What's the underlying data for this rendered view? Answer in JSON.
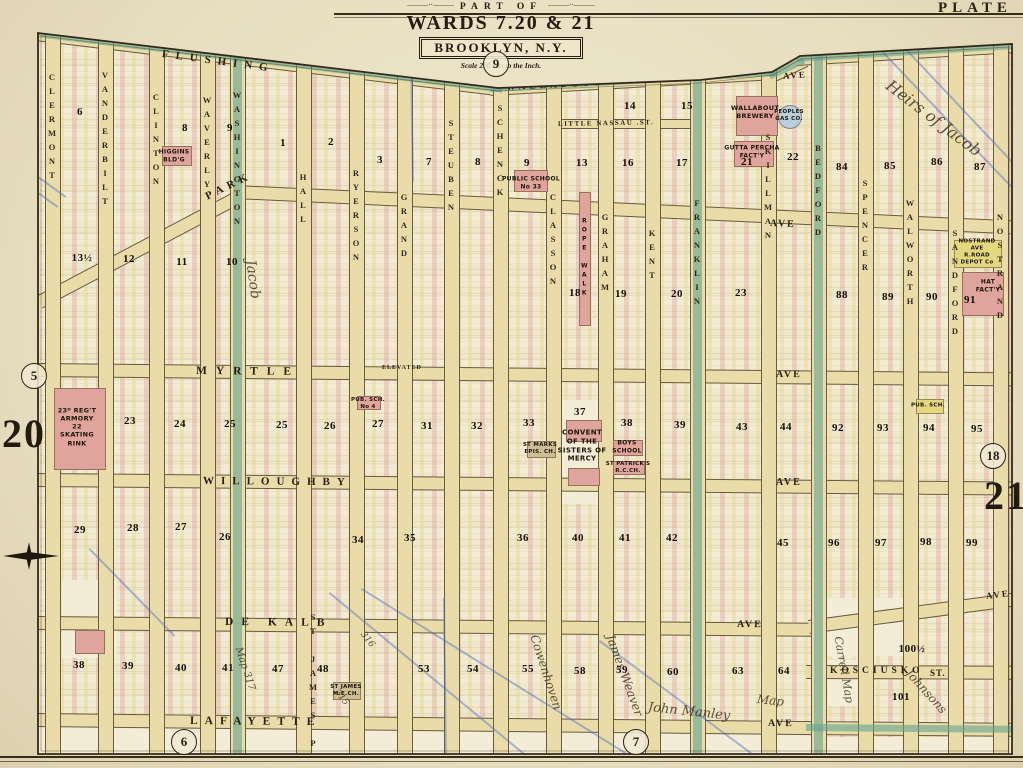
{
  "plate": {
    "label": "PLATE",
    "page_number_left": "20",
    "page_number_right": "21",
    "adjacent_plates": {
      "top": "9",
      "left": "5",
      "bottom_left": "6",
      "bottom_center": "7",
      "right": "18"
    },
    "title": {
      "part_of": "PART OF",
      "wards": "WARDS 7.20 & 21",
      "city": "BROOKLYN, N.Y.",
      "scale": "Scale 200 feet to the Inch."
    }
  },
  "colors": {
    "paper": "#e8dfc1",
    "sheet": "#f0e8cd",
    "street": "#e9dca9",
    "teal_street": "#62a48e",
    "lot_pink": "#dfa49c",
    "lot_yellow": "#e4d87e",
    "cream": "#f3edd7",
    "tan": "#cdbd92",
    "ink": "#271f10",
    "blue_pencil": "#4b6cbe"
  },
  "streets": {
    "vertical": [
      {
        "name": "CLERMONT",
        "x": 52,
        "y0": 35,
        "ly": 72,
        "teal": false
      },
      {
        "name": "VANDERBILT",
        "x": 105,
        "y0": 41,
        "ly": 70,
        "teal": false
      },
      {
        "name": "CLINTON",
        "x": 156,
        "y0": 47,
        "ly": 92,
        "teal": false
      },
      {
        "name": "WAVERLY",
        "x": 207,
        "y0": 53,
        "ly": 95,
        "teal": false
      },
      {
        "name": "WASHINGTON",
        "x": 237,
        "y0": 57,
        "ly": 90,
        "teal": true
      },
      {
        "name": "HALL",
        "x": 303,
        "y0": 65,
        "ly": 172,
        "teal": false
      },
      {
        "name": "RYERSON",
        "x": 356,
        "y0": 71,
        "ly": 168,
        "teal": false
      },
      {
        "name": "GRAND",
        "x": 404,
        "y0": 77,
        "ly": 192,
        "teal": false
      },
      {
        "name": "STEUBEN",
        "x": 451,
        "y0": 82,
        "ly": 118,
        "teal": false
      },
      {
        "name": "SCHENCK",
        "x": 500,
        "y0": 88,
        "ly": 103,
        "teal": false
      },
      {
        "name": "CLASSON",
        "x": 553,
        "y0": 85,
        "ly": 192,
        "teal": false
      },
      {
        "name": "GRAHAM",
        "x": 605,
        "y0": 82,
        "ly": 212,
        "teal": false
      },
      {
        "name": "KENT",
        "x": 652,
        "y0": 79,
        "ly": 228,
        "teal": false
      },
      {
        "name": "FRANKLIN",
        "x": 697,
        "y0": 76,
        "ly": 198,
        "teal": true
      },
      {
        "name": "SKILLMAN",
        "x": 768,
        "y0": 72,
        "ly": 132,
        "teal": false
      },
      {
        "name": "BEDFORD",
        "x": 818,
        "y0": 55,
        "ly": 143,
        "teal": true
      },
      {
        "name": "SPENCER",
        "x": 865,
        "y0": 52,
        "ly": 178,
        "teal": false
      },
      {
        "name": "WALWORTH",
        "x": 910,
        "y0": 50,
        "ly": 198,
        "teal": false
      },
      {
        "name": "SANDFORD",
        "x": 955,
        "y0": 47,
        "ly": 228,
        "teal": false
      },
      {
        "name": "NOSTRAND",
        "x": 1000,
        "y0": 45,
        "ly": 212,
        "teal": false
      },
      {
        "name": "ST JAMES PL",
        "x": 313,
        "y0": 615,
        "ly": 612,
        "teal": false,
        "noband": true
      }
    ],
    "horizontal": [
      {
        "name": "flushing",
        "x": 36,
        "y": 27,
        "len": 470,
        "rot": 6.8,
        "teal": true
      },
      {
        "name": "wallabout-road",
        "x": 490,
        "y": 82,
        "len": 286,
        "rot": -3.2,
        "teal": true
      },
      {
        "name": "road-bend",
        "x": 768,
        "y": 70,
        "len": 38,
        "rot": -25,
        "teal": true
      },
      {
        "name": "flushing-ave-east",
        "x": 796,
        "y": 52,
        "len": 218,
        "rot": -3.4,
        "teal": true
      },
      {
        "name": "little-nassau",
        "x": 553,
        "y": 119,
        "len": 150,
        "rot": 0,
        "thin": true,
        "teal": false
      },
      {
        "name": "park-diagonal",
        "x": 36,
        "y": 296,
        "len": 228,
        "rot": -27.8,
        "teal": false
      },
      {
        "name": "park",
        "x": 234,
        "y": 185,
        "len": 778,
        "rot": 2.6,
        "teal": false
      },
      {
        "name": "myrtle",
        "x": 36,
        "y": 363,
        "len": 976,
        "rot": 0.55,
        "teal": false
      },
      {
        "name": "willoughby",
        "x": 36,
        "y": 473,
        "len": 976,
        "rot": 0.5,
        "teal": false
      },
      {
        "name": "dekalb",
        "x": 36,
        "y": 616,
        "len": 777,
        "rot": 0.5,
        "teal": false
      },
      {
        "name": "dekalb-east",
        "x": 808,
        "y": 620,
        "len": 206,
        "rot": -7.6,
        "teal": false
      },
      {
        "name": "lafayette",
        "x": 36,
        "y": 713,
        "len": 777,
        "rot": 0.6,
        "teal": false
      },
      {
        "name": "lafayette-east",
        "x": 806,
        "y": 721,
        "len": 206,
        "rot": 0.5,
        "teal": true
      },
      {
        "name": "kosciusko",
        "x": 806,
        "y": 665,
        "len": 206,
        "rot": 0.2,
        "teal": false
      }
    ],
    "labels": [
      {
        "t": "FLUSHING",
        "x": 162,
        "y": 48,
        "rot": 7.5,
        "sp": 7,
        "sz": 11
      },
      {
        "t": "WALLABOUT",
        "x": 506,
        "y": 83,
        "rot": -3,
        "sp": 4,
        "sz": 9.5
      },
      {
        "t": "ROAD",
        "x": 775,
        "y": 56,
        "rot": -23,
        "sp": 3,
        "sz": 9
      },
      {
        "t": "AVE",
        "x": 783,
        "y": 71,
        "rot": -4,
        "sp": 2,
        "sz": 9
      },
      {
        "t": "LITTLE NASSAU .ST.",
        "x": 558,
        "y": 120,
        "rot": -1,
        "sp": 1.5,
        "sz": 7
      },
      {
        "t": "PARK",
        "x": 206,
        "y": 191,
        "rot": -26,
        "sp": 5,
        "sz": 11
      },
      {
        "t": "AVE",
        "x": 770,
        "y": 218,
        "rot": 2,
        "sp": 2,
        "sz": 10
      },
      {
        "t": "MYRTLE",
        "x": 196,
        "y": 365,
        "rot": 0.5,
        "sp": 9,
        "sz": 11.5
      },
      {
        "t": "ELEVATED",
        "x": 382,
        "y": 365,
        "rot": 0,
        "sp": 1,
        "sz": 6
      },
      {
        "t": "AVE",
        "x": 776,
        "y": 369,
        "rot": 0.5,
        "sp": 2,
        "sz": 10
      },
      {
        "t": "WILLOUGHBY",
        "x": 203,
        "y": 475,
        "rot": 0.5,
        "sp": 7,
        "sz": 11
      },
      {
        "t": "AVE",
        "x": 776,
        "y": 477,
        "rot": 0,
        "sp": 2,
        "sz": 10
      },
      {
        "t": "DE KALB",
        "x": 225,
        "y": 616,
        "rot": 0.5,
        "sp": 8,
        "sz": 11.5
      },
      {
        "t": "AVE",
        "x": 737,
        "y": 619,
        "rot": 0.5,
        "sp": 2,
        "sz": 10
      },
      {
        "t": "AVE",
        "x": 986,
        "y": 591,
        "rot": -7,
        "sp": 2,
        "sz": 9
      },
      {
        "t": "LAFAYETTE",
        "x": 190,
        "y": 715,
        "rot": 0.5,
        "sp": 7,
        "sz": 11.5
      },
      {
        "t": "AVE",
        "x": 768,
        "y": 718,
        "rot": 0.5,
        "sp": 2,
        "sz": 10
      },
      {
        "t": "KOSCIUSKO",
        "x": 830,
        "y": 666,
        "rot": 0,
        "sp": 4,
        "sz": 9.5
      },
      {
        "t": "ST.",
        "x": 930,
        "y": 668,
        "rot": 0,
        "sp": 1,
        "sz": 9
      }
    ]
  },
  "blocks": [
    {
      "n": "6",
      "x": 80,
      "y": 112
    },
    {
      "n": "8",
      "x": 185,
      "y": 128
    },
    {
      "n": "9",
      "x": 230,
      "y": 128
    },
    {
      "n": "1",
      "x": 283,
      "y": 143
    },
    {
      "n": "2",
      "x": 331,
      "y": 142
    },
    {
      "n": "3",
      "x": 380,
      "y": 160
    },
    {
      "n": "7",
      "x": 429,
      "y": 162
    },
    {
      "n": "8",
      "x": 478,
      "y": 162
    },
    {
      "n": "9",
      "x": 527,
      "y": 163
    },
    {
      "n": "13",
      "x": 582,
      "y": 163
    },
    {
      "n": "14",
      "x": 630,
      "y": 106
    },
    {
      "n": "15",
      "x": 687,
      "y": 106
    },
    {
      "n": "16",
      "x": 628,
      "y": 163
    },
    {
      "n": "17",
      "x": 682,
      "y": 163
    },
    {
      "n": "21",
      "x": 747,
      "y": 162
    },
    {
      "n": "22",
      "x": 793,
      "y": 157
    },
    {
      "n": "84",
      "x": 842,
      "y": 167
    },
    {
      "n": "85",
      "x": 890,
      "y": 166
    },
    {
      "n": "86",
      "x": 937,
      "y": 162
    },
    {
      "n": "87",
      "x": 980,
      "y": 167
    },
    {
      "n": "13½",
      "x": 82,
      "y": 258
    },
    {
      "n": "12",
      "x": 129,
      "y": 259
    },
    {
      "n": "11",
      "x": 182,
      "y": 262
    },
    {
      "n": "10",
      "x": 232,
      "y": 262
    },
    {
      "n": "18",
      "x": 575,
      "y": 293
    },
    {
      "n": "19",
      "x": 621,
      "y": 294
    },
    {
      "n": "20",
      "x": 677,
      "y": 294
    },
    {
      "n": "23",
      "x": 741,
      "y": 293
    },
    {
      "n": "88",
      "x": 842,
      "y": 295
    },
    {
      "n": "89",
      "x": 888,
      "y": 297
    },
    {
      "n": "90",
      "x": 932,
      "y": 297
    },
    {
      "n": "91",
      "x": 970,
      "y": 300
    },
    {
      "n": "23",
      "x": 130,
      "y": 421
    },
    {
      "n": "24",
      "x": 180,
      "y": 424
    },
    {
      "n": "25",
      "x": 230,
      "y": 424
    },
    {
      "n": "25",
      "x": 282,
      "y": 425
    },
    {
      "n": "26",
      "x": 330,
      "y": 426
    },
    {
      "n": "27",
      "x": 378,
      "y": 424
    },
    {
      "n": "31",
      "x": 427,
      "y": 426
    },
    {
      "n": "32",
      "x": 477,
      "y": 426
    },
    {
      "n": "33",
      "x": 529,
      "y": 423
    },
    {
      "n": "37",
      "x": 580,
      "y": 412
    },
    {
      "n": "38",
      "x": 627,
      "y": 423
    },
    {
      "n": "39",
      "x": 680,
      "y": 425
    },
    {
      "n": "43",
      "x": 742,
      "y": 427
    },
    {
      "n": "44",
      "x": 786,
      "y": 427
    },
    {
      "n": "92",
      "x": 838,
      "y": 428
    },
    {
      "n": "93",
      "x": 883,
      "y": 428
    },
    {
      "n": "94",
      "x": 929,
      "y": 428
    },
    {
      "n": "95",
      "x": 977,
      "y": 429
    },
    {
      "n": "29",
      "x": 80,
      "y": 530
    },
    {
      "n": "28",
      "x": 133,
      "y": 528
    },
    {
      "n": "27",
      "x": 181,
      "y": 527
    },
    {
      "n": "26",
      "x": 225,
      "y": 537
    },
    {
      "n": "34",
      "x": 358,
      "y": 540
    },
    {
      "n": "35",
      "x": 410,
      "y": 538
    },
    {
      "n": "36",
      "x": 523,
      "y": 538
    },
    {
      "n": "40",
      "x": 578,
      "y": 538
    },
    {
      "n": "41",
      "x": 625,
      "y": 538
    },
    {
      "n": "42",
      "x": 672,
      "y": 538
    },
    {
      "n": "45",
      "x": 783,
      "y": 543
    },
    {
      "n": "96",
      "x": 834,
      "y": 543
    },
    {
      "n": "97",
      "x": 881,
      "y": 543
    },
    {
      "n": "98",
      "x": 926,
      "y": 542
    },
    {
      "n": "99",
      "x": 972,
      "y": 543
    },
    {
      "n": "38",
      "x": 79,
      "y": 665
    },
    {
      "n": "39",
      "x": 128,
      "y": 666
    },
    {
      "n": "40",
      "x": 181,
      "y": 668
    },
    {
      "n": "41",
      "x": 228,
      "y": 668
    },
    {
      "n": "47",
      "x": 278,
      "y": 669
    },
    {
      "n": "48",
      "x": 323,
      "y": 669
    },
    {
      "n": "53",
      "x": 424,
      "y": 669
    },
    {
      "n": "54",
      "x": 473,
      "y": 669
    },
    {
      "n": "55",
      "x": 528,
      "y": 669
    },
    {
      "n": "58",
      "x": 580,
      "y": 671
    },
    {
      "n": "59",
      "x": 622,
      "y": 670
    },
    {
      "n": "60",
      "x": 673,
      "y": 672
    },
    {
      "n": "63",
      "x": 738,
      "y": 671
    },
    {
      "n": "64",
      "x": 784,
      "y": 671
    },
    {
      "n": "100½",
      "x": 912,
      "y": 649
    },
    {
      "n": "101",
      "x": 901,
      "y": 697
    }
  ],
  "landmarks": [
    {
      "t": "23ᴰ REG'T\nARMORY\n22\nSKATING\nRINK",
      "x": 77,
      "y": 427,
      "sz": 6.5
    },
    {
      "t": "HIGGINS\nBLD'G",
      "x": 174,
      "y": 156,
      "sz": 6
    },
    {
      "t": "PUBLIC SCHOOL\nNo 33",
      "x": 531,
      "y": 183,
      "sz": 6
    },
    {
      "t": "PUB. SCH.\nNo 4",
      "x": 368,
      "y": 404,
      "sz": 5.5
    },
    {
      "t": "ROPE WALK",
      "x": 584,
      "y": 258,
      "sz": 6,
      "vert": true
    },
    {
      "t": "WALLABOUT\nBREWERY",
      "x": 755,
      "y": 112,
      "sz": 6.5
    },
    {
      "t": "GUTTA PERCHA\nFACT'Y",
      "x": 752,
      "y": 152,
      "sz": 6
    },
    {
      "t": "PEOPLES\nGAS CO.",
      "x": 789,
      "y": 116,
      "sz": 5.5
    },
    {
      "t": "ST MARKS\nEPIS. CH.",
      "x": 540,
      "y": 449,
      "sz": 5.5
    },
    {
      "t": "CONVENT\nOF THE\nSISTERS OF\nMERCY",
      "x": 582,
      "y": 446,
      "sz": 7
    },
    {
      "t": "BOYS\nSCHOOL",
      "x": 627,
      "y": 447,
      "sz": 6
    },
    {
      "t": "ST PATRICK'S\nR.C.CH.",
      "x": 628,
      "y": 468,
      "sz": 5.5
    },
    {
      "t": "NOSTRAND AVE\nR.ROAD\nDEPOT Co",
      "x": 977,
      "y": 252,
      "sz": 5.5
    },
    {
      "t": "HAT\nFACT'Y",
      "x": 988,
      "y": 286,
      "sz": 6
    },
    {
      "t": "ST JAMES\nM.E.CH.",
      "x": 346,
      "y": 691,
      "sz": 5.5
    },
    {
      "t": "PUB. SCH.",
      "x": 928,
      "y": 406,
      "sz": 5.5
    }
  ],
  "annotations": [
    {
      "t": "Heirs of Jacob",
      "x": 888,
      "y": 74,
      "rot": 37,
      "sz": 16
    },
    {
      "t": "Jacob",
      "x": 250,
      "y": 252,
      "rot": 82,
      "sz": 14
    },
    {
      "t": "Cowenhoven",
      "x": 534,
      "y": 628,
      "rot": 72,
      "sz": 12
    },
    {
      "t": "James Weaver",
      "x": 610,
      "y": 628,
      "rot": 70,
      "sz": 12
    },
    {
      "t": "John Manley",
      "x": 648,
      "y": 700,
      "rot": 6,
      "sz": 13
    },
    {
      "t": "Map",
      "x": 757,
      "y": 692,
      "rot": 6,
      "sz": 12
    },
    {
      "t": "Johnsons",
      "x": 908,
      "y": 664,
      "rot": 48,
      "sz": 12
    },
    {
      "t": "Carrell Map",
      "x": 838,
      "y": 630,
      "rot": 80,
      "sz": 11
    },
    {
      "t": "Map 317",
      "x": 238,
      "y": 642,
      "rot": 72,
      "sz": 10
    },
    {
      "t": "316",
      "x": 362,
      "y": 628,
      "rot": 52,
      "sz": 9
    },
    {
      "t": "315",
      "x": 336,
      "y": 686,
      "rot": 52,
      "sz": 9
    }
  ],
  "pencil_lines": [
    {
      "x0": 0,
      "y0": 148,
      "x1": 66,
      "y1": 196
    },
    {
      "x0": 0,
      "y0": 164,
      "x1": 58,
      "y1": 206
    },
    {
      "x0": 884,
      "y0": 52,
      "x1": 1012,
      "y1": 186
    },
    {
      "x0": 908,
      "y0": 50,
      "x1": 1023,
      "y1": 172
    },
    {
      "x0": 330,
      "y0": 592,
      "x1": 540,
      "y1": 766
    },
    {
      "x0": 362,
      "y0": 588,
      "x1": 648,
      "y1": 766
    },
    {
      "x0": 445,
      "y0": 598,
      "x1": 447,
      "y1": 762
    },
    {
      "x0": 412,
      "y0": 58,
      "x1": 414,
      "y1": 182
    },
    {
      "x0": 499,
      "y0": 2,
      "x1": 501,
      "y1": 90
    },
    {
      "x0": 90,
      "y0": 548,
      "x1": 175,
      "y1": 635
    },
    {
      "x0": 600,
      "y0": 640,
      "x1": 770,
      "y1": 766
    }
  ],
  "patches": [
    {
      "x": 556,
      "y": 400,
      "w": 52,
      "h": 104,
      "c": "cream",
      "layer": 0
    },
    {
      "x": 826,
      "y": 598,
      "w": 82,
      "h": 58,
      "c": "cream",
      "layer": 0
    },
    {
      "x": 62,
      "y": 580,
      "w": 55,
      "h": 78,
      "c": "cream",
      "layer": 0
    },
    {
      "x": 828,
      "y": 660,
      "w": 46,
      "h": 46,
      "c": "cream",
      "layer": 0
    },
    {
      "x": 38,
      "y": 727,
      "w": 774,
      "h": 27,
      "c": "cream",
      "layer": 0
    },
    {
      "x": 806,
      "y": 737,
      "w": 206,
      "h": 17,
      "c": "cream",
      "layer": 0
    },
    {
      "x": 54,
      "y": 388,
      "w": 50,
      "h": 80,
      "c": "pink",
      "layer": 1
    },
    {
      "x": 566,
      "y": 420,
      "w": 34,
      "h": 20,
      "c": "pink",
      "layer": 1
    },
    {
      "x": 568,
      "y": 468,
      "w": 30,
      "h": 16,
      "c": "pink",
      "layer": 1
    },
    {
      "x": 613,
      "y": 440,
      "w": 28,
      "h": 14,
      "c": "pink",
      "layer": 1
    },
    {
      "x": 613,
      "y": 461,
      "w": 30,
      "h": 12,
      "c": "pink",
      "layer": 1
    },
    {
      "x": 736,
      "y": 96,
      "w": 40,
      "h": 38,
      "c": "pink",
      "layer": 1
    },
    {
      "x": 734,
      "y": 141,
      "w": 38,
      "h": 24,
      "c": "pink",
      "layer": 1
    },
    {
      "x": 962,
      "y": 272,
      "w": 40,
      "h": 42,
      "c": "pink",
      "layer": 1
    },
    {
      "x": 579,
      "y": 192,
      "w": 10,
      "h": 132,
      "c": "pink",
      "layer": 1
    },
    {
      "x": 514,
      "y": 170,
      "w": 32,
      "h": 20,
      "c": "pink",
      "layer": 1
    },
    {
      "x": 357,
      "y": 396,
      "w": 22,
      "h": 12,
      "c": "pink",
      "layer": 1
    },
    {
      "x": 162,
      "y": 146,
      "w": 28,
      "h": 18,
      "c": "pink",
      "layer": 1
    },
    {
      "x": 75,
      "y": 630,
      "w": 28,
      "h": 22,
      "c": "pink",
      "layer": 1
    },
    {
      "x": 527,
      "y": 441,
      "w": 27,
      "h": 15,
      "c": "tan",
      "layer": 1
    },
    {
      "x": 333,
      "y": 682,
      "w": 26,
      "h": 16,
      "c": "tan",
      "layer": 1
    },
    {
      "x": 954,
      "y": 240,
      "w": 46,
      "h": 26,
      "c": "yellow",
      "layer": 1
    },
    {
      "x": 916,
      "y": 399,
      "w": 26,
      "h": 13,
      "c": "yellow",
      "layer": 1
    },
    {
      "x": 778,
      "y": 105,
      "w": 22,
      "h": 22,
      "c": "blue",
      "layer": 1,
      "round": true
    }
  ]
}
